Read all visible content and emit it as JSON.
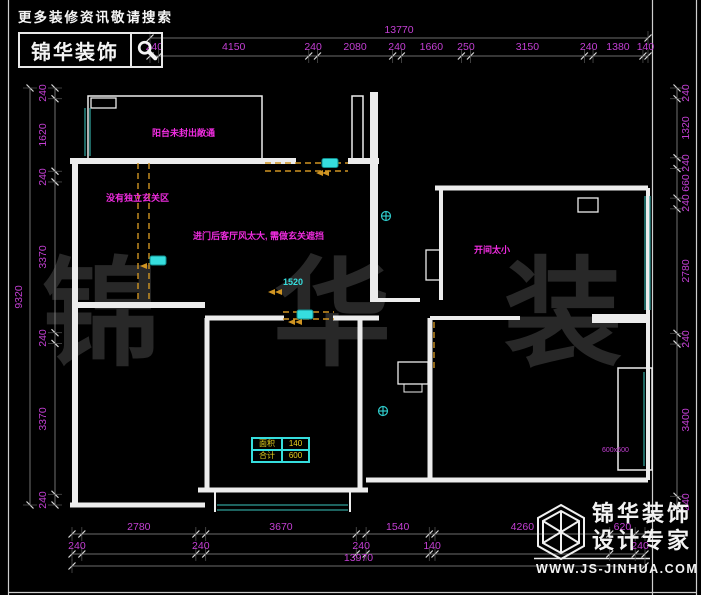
{
  "header": {
    "slogan": "更多装修资讯敬请搜索",
    "logo_text": "锦华装饰"
  },
  "watermark": "锦 华 装 饰",
  "footer": {
    "brand_line1": "锦华装饰",
    "brand_line2": "设计专家",
    "url": "WWW.JS-JINHUA.COM"
  },
  "dimensions": {
    "top_total": 13770,
    "top": [
      240,
      4150,
      240,
      2080,
      240,
      1660,
      250,
      3150,
      240,
      1380,
      140
    ],
    "left_total": 9320,
    "left": [
      240,
      1620,
      240,
      3370,
      240,
      3370,
      240
    ],
    "right": [
      240,
      1320,
      240,
      660,
      240,
      2780,
      240,
      3400,
      240
    ],
    "bottom": [
      240,
      2780,
      240,
      3670,
      240,
      1540,
      140,
      4260,
      620,
      240
    ],
    "bottom_total": 13970
  },
  "annotations": {
    "balcony_note": "阳台未封出敞通",
    "entry_note": "没有独立玄关区",
    "living_note": "进门后客厅风太大, 需做玄关遮挡",
    "bedroom_note": "开间太小",
    "door_width_tag": "1520",
    "bay_window_tag": "600x600"
  },
  "area_table": {
    "rows": [
      [
        "面积",
        "140"
      ],
      [
        "合计",
        "600"
      ]
    ]
  },
  "colors": {
    "dimension_text": "#c43fd4",
    "annotation_text": "#f02ce0",
    "window_line": "#2f9e98",
    "dashed_wall": "#cf9422",
    "marker_cyan": "#36dede",
    "wall": "#ececec",
    "background": "#000000"
  }
}
